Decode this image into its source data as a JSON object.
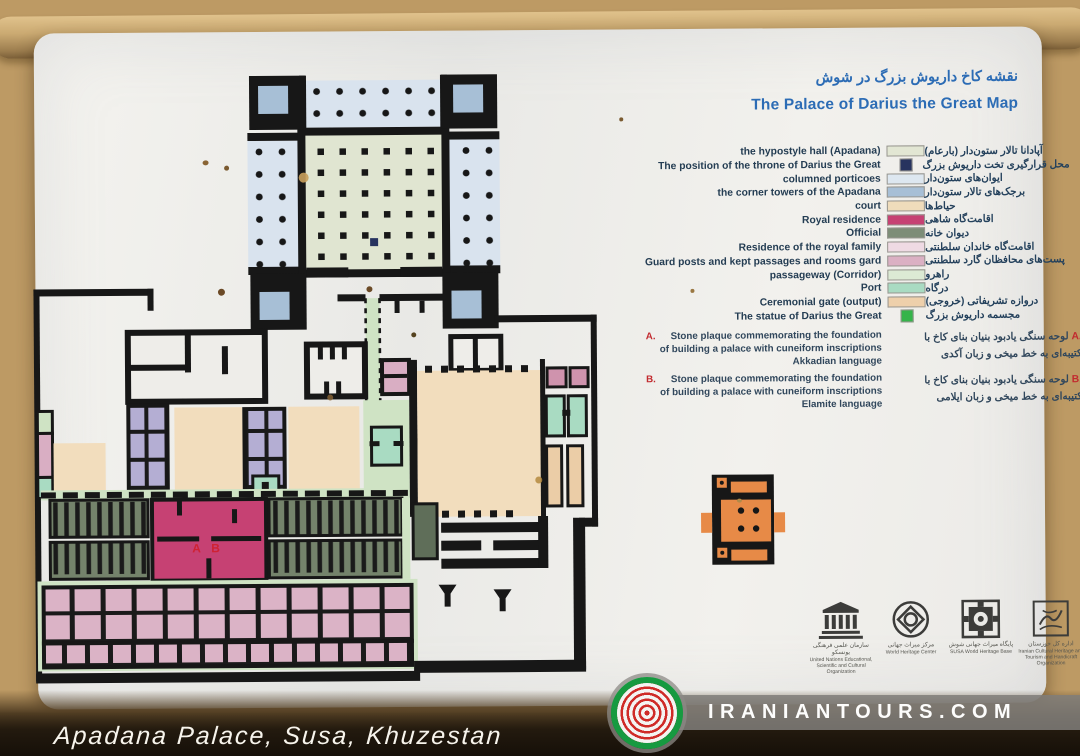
{
  "photo": {
    "caption": "Apadana Palace, Susa, Khuzestan"
  },
  "watermark": {
    "text": "IRANIANTOURS.COM"
  },
  "panel": {
    "title_fa": "نقشه کاخ داریوش بزرگ در شوش",
    "title_en": "The Palace of Darius the Great Map",
    "accent_color": "#2c6cb5",
    "red_color": "#c22a2f",
    "legend": {
      "items": [
        {
          "en": "the hypostyle hall (Apadana)",
          "fa": "آپادانا تالار ستون‌دار (بارعام)",
          "color": "#e2e6d3"
        },
        {
          "en": "The position of the throne of Darius the Great",
          "fa": "محل قرارگیری تخت داریوش بزرگ",
          "color": "#27335f"
        },
        {
          "en": "columned porticoes",
          "fa": "ایوان‌های ستون‌دار",
          "color": "#dde7f0"
        },
        {
          "en": "the corner towers of the Apadana",
          "fa": "برجک‌های تالار ستون‌دار",
          "color": "#a7bfd6"
        },
        {
          "en": "court",
          "fa": "حیاط‌ها",
          "color": "#efdcbb"
        },
        {
          "en": "Royal residence",
          "fa": "اقامت‌گاه شاهی",
          "color": "#c64173"
        },
        {
          "en": "Official",
          "fa": "دیوان خانه",
          "color": "#7d8d77"
        },
        {
          "en": "Residence of the royal family",
          "fa": "اقامت‌گاه خاندان سلطنتی",
          "color": "#efdae3"
        },
        {
          "en": "Guard posts and kept passages and rooms gard",
          "fa": "پست‌های محافظان گارد سلطنتی",
          "color": "#dbb0c3"
        },
        {
          "en": "passageway (Corridor)",
          "fa": "راهرو",
          "color": "#dcead4"
        },
        {
          "en": "Port",
          "fa": "درگاه",
          "color": "#a9dbc2"
        },
        {
          "en": "Ceremonial gate (output)",
          "fa": "دروازه تشریفاتی (خروجی)",
          "color": "#eed0ab"
        },
        {
          "en": "The statue of Darius the Great",
          "fa": "مجسمه داریوش بزرگ",
          "color": "#35b44a"
        }
      ]
    },
    "notes": [
      {
        "label": "A.",
        "en1": "Stone plaque commemorating the foundation",
        "en2": "of building a palace with cuneiform inscriptions",
        "en3": "Akkadian language",
        "fa_label": ".A",
        "fa1": "لوحه سنگی یادبود بنیان بنای کاخ با",
        "fa2": "کتیبه‌ای به خط میخی و زبان آکدی"
      },
      {
        "label": "B.",
        "en1": "Stone plaque commemorating the foundation",
        "en2": "of building a palace with cuneiform inscriptions",
        "en3": "Elamite language",
        "fa_label": ".B",
        "fa1": "لوحه سنگی یادبود بنیان بنای کاخ با",
        "fa2": "کتیبه‌ای به خط میخی و زبان ایلامی"
      }
    ],
    "logos": [
      {
        "fa": "سازمان علمی فرهنگی یونسکو",
        "en": "United Nations Educational, Scientific and Cultural Organization"
      },
      {
        "fa": "مرکز میراث جهانی",
        "en": "World Heritage Center"
      },
      {
        "fa": "پایگاه میراث جهانی شوش",
        "en": "SUSA World Heritage Base"
      },
      {
        "fa": "اداره کل خوزستان",
        "en": "Iranian Cultural Heritage and Tourism and Handicraft Organization"
      }
    ]
  },
  "map": {
    "label_a": "A",
    "label_b": "B"
  }
}
